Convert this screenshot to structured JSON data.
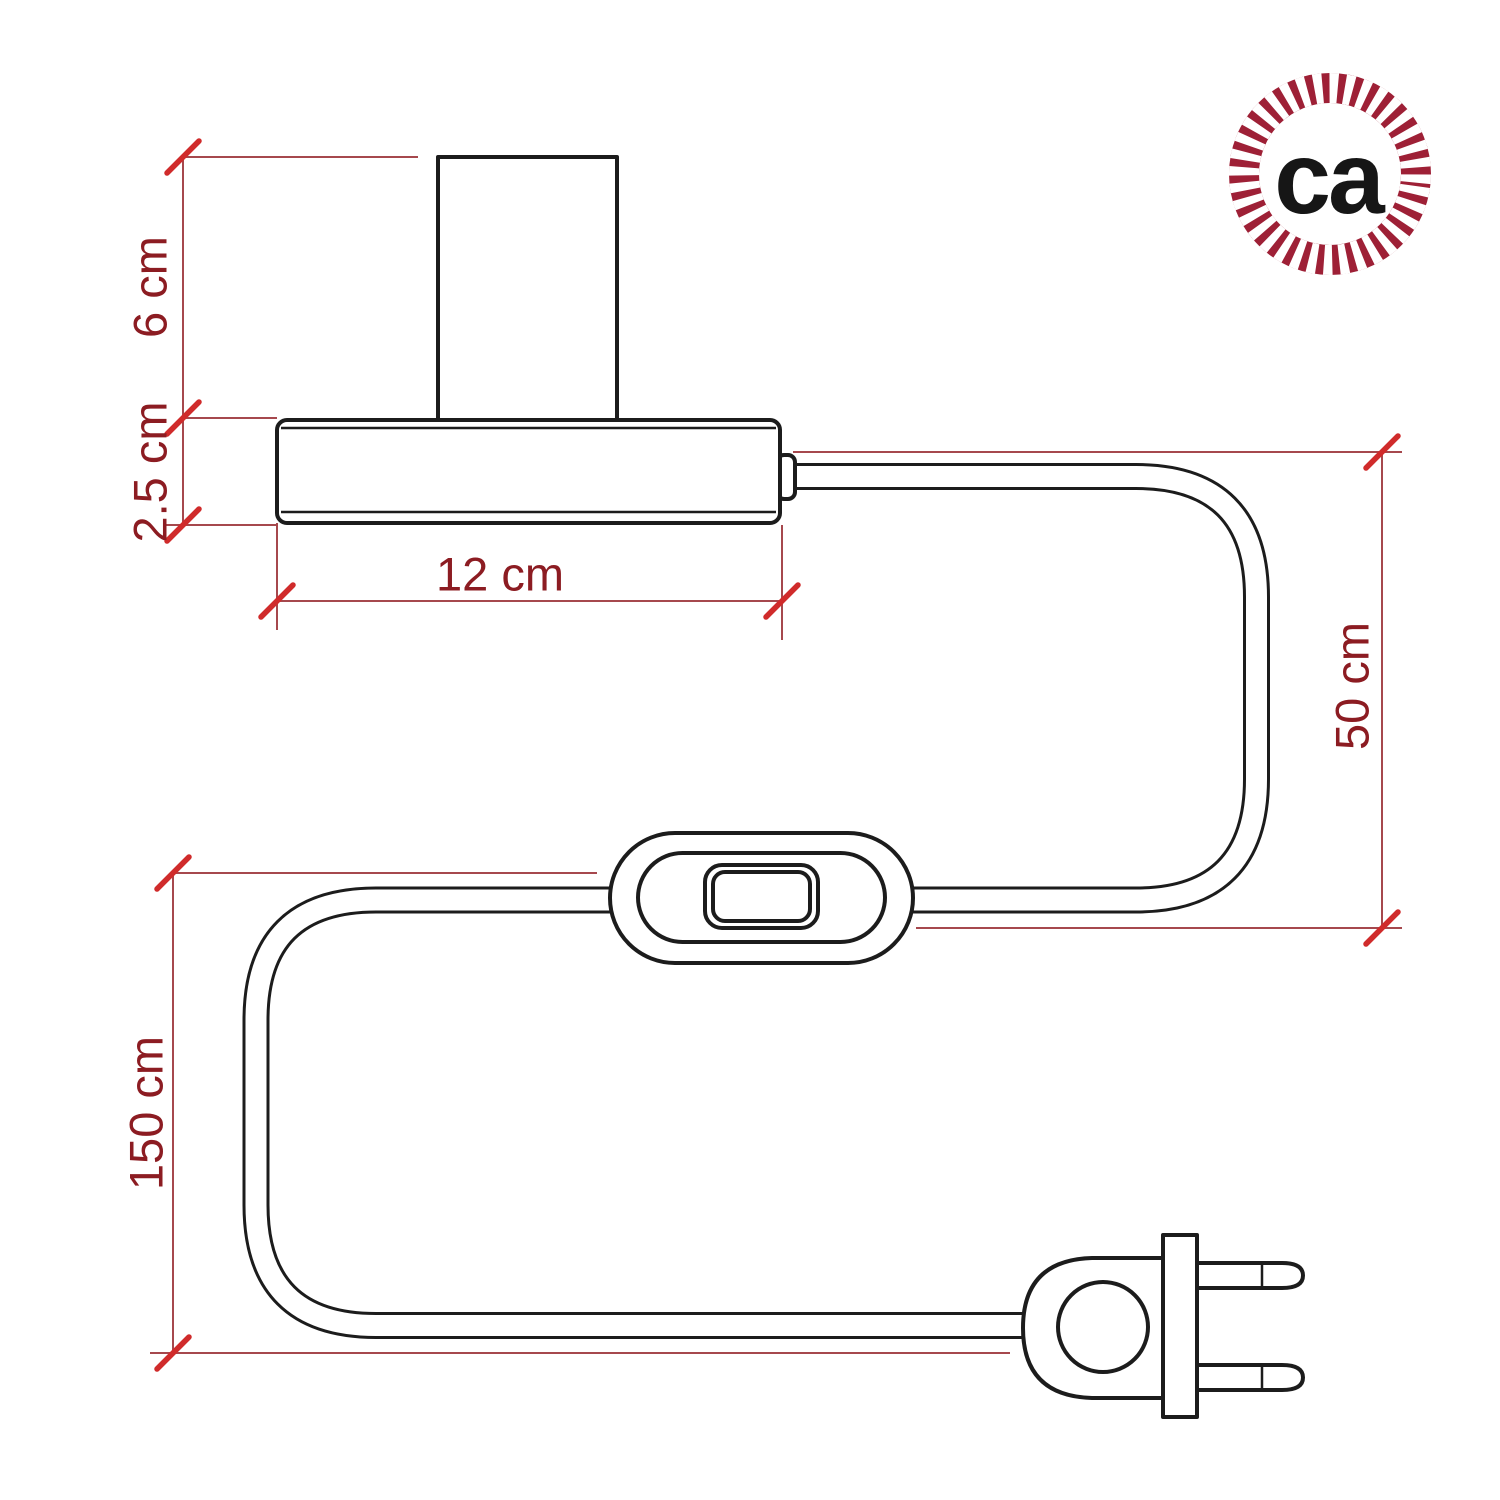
{
  "page": {
    "title": "Table lamp with inline switch and two-pin plug - dimension drawing"
  },
  "colors": {
    "background": "#ffffff",
    "line": "#1c1c1c",
    "dimension_line": "#a6484d",
    "tick": "#d02b2b",
    "label_text": "#8c1c22",
    "logo_ring": "#9e2036",
    "logo_text": "#161616"
  },
  "dimensions": [
    {
      "id": "socket-height",
      "label": "6 cm",
      "orientation": "vertical"
    },
    {
      "id": "base-height",
      "label": "2.5 cm",
      "orientation": "vertical"
    },
    {
      "id": "base-width",
      "label": "12 cm",
      "orientation": "horizontal"
    },
    {
      "id": "cable-base-to-switch",
      "label": "50 cm",
      "orientation": "vertical"
    },
    {
      "id": "cable-switch-to-plug",
      "label": "150 cm",
      "orientation": "vertical"
    }
  ],
  "logo": {
    "text": "ca"
  }
}
